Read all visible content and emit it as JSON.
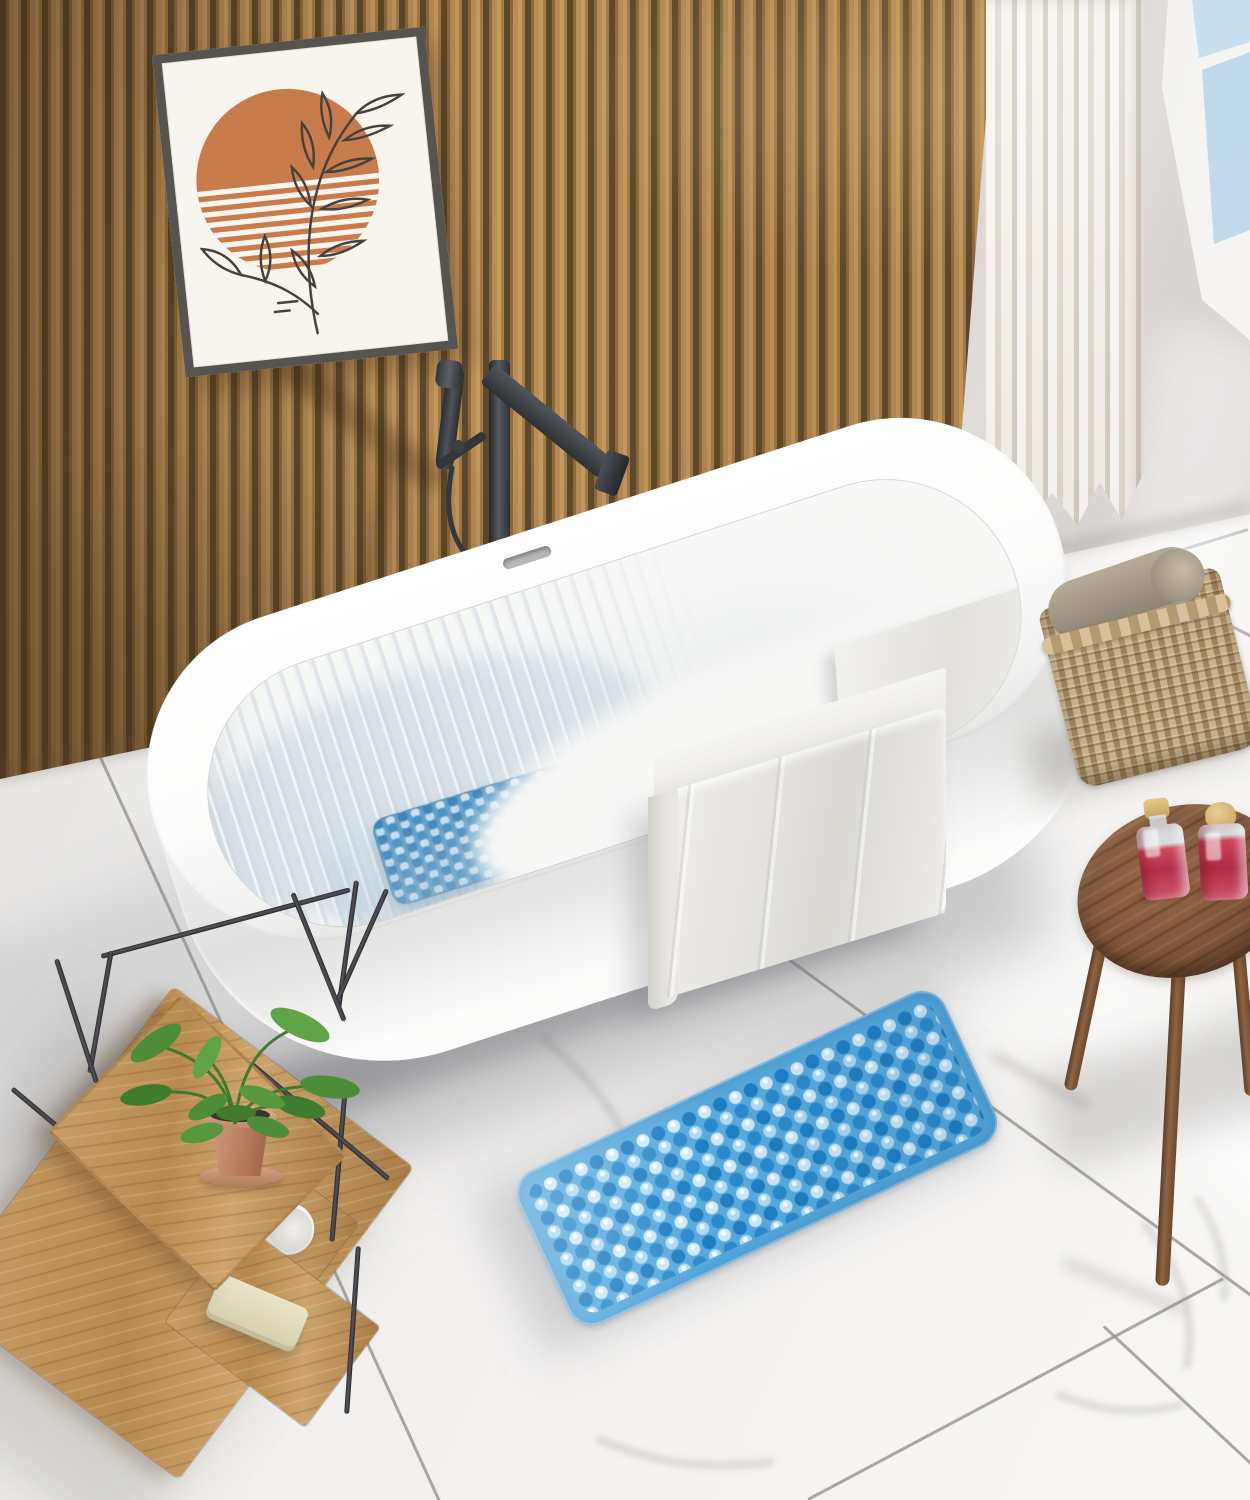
{
  "meta": {
    "domain": "natural-image",
    "description": "Top-down 3D rendered bathroom scene: white freestanding bathtub against a wood slat wall, blue non-slip suction-cup bath mats inside the tub and on the white marble floor, wooden bath trolley with plant, wicker basket with rolled towels, round wooden stool with two red toiletry bottles, white curtain and window",
    "canvas": {
      "width": 1250,
      "height": 1500
    }
  },
  "palette": {
    "wood_slat": "#b98e55",
    "wood_gap": "#5e492c",
    "frame": "#57534e",
    "art_sun": "#c87c4b",
    "faucet": "#33363a",
    "tub_white": "#ffffff",
    "mat_base": "#58aadd",
    "mat_dark_dot": "#1f7ec1",
    "mat_light_dot": "#cfe9f8",
    "towel": "#e6e4e0",
    "floor": "#f1efed",
    "grout": "#8e8c88",
    "shelf_wood": "#b98a50",
    "metal": "#55555b",
    "leaf": "#4e8d38",
    "pot": "#b87a5c",
    "basket": "#b89a6f",
    "basket_towel": "#a89c8b",
    "stool_wood": "#7d5439",
    "liquid": "#b43049",
    "cap": "#c6a15e",
    "glass": "#c8dff0",
    "curtain": "#f2eee7",
    "wall_gray": "#d6d2d0"
  },
  "objects": {
    "wood_slat_wall": {
      "label": "Vertical wood slat accent wall"
    },
    "wall_art": {
      "label": "Framed abstract art: terracotta striped sun with black line-art branch"
    },
    "faucet": {
      "label": "Freestanding gunmetal tub filler with hand sprayer"
    },
    "bathtub": {
      "label": "White freestanding oval bathtub with water"
    },
    "tub_bath_mat": {
      "label": "Blue suction-cup bath mat submerged inside tub"
    },
    "bath_towel": {
      "label": "Light gray towel draped over tub rim"
    },
    "floor_bath_mat": {
      "label": "Blue non-slip suction-cup bath mat on marble floor"
    },
    "marble_floor": {
      "label": "Large white marble tiles with thin grout lines"
    },
    "shelf_unit": {
      "label": "Wood and metal bath trolley",
      "items": [
        "potted plant",
        "rolled white towel",
        "soap bar"
      ]
    },
    "plant": {
      "label": "Green plant in terracotta pot"
    },
    "wicker_basket": {
      "label": "Wicker basket holding rolled towels",
      "towel_count": 2
    },
    "stool": {
      "label": "Round walnut stool",
      "leg_count": 3
    },
    "bottles": {
      "label": "Toiletry bottles with red liquid and gold caps",
      "count": 2
    },
    "window": {
      "label": "White framed window showing blue sky"
    },
    "curtain": {
      "label": "Floor-length white sheer curtain"
    },
    "right_wall": {
      "label": "Plain warm gray wall"
    }
  }
}
